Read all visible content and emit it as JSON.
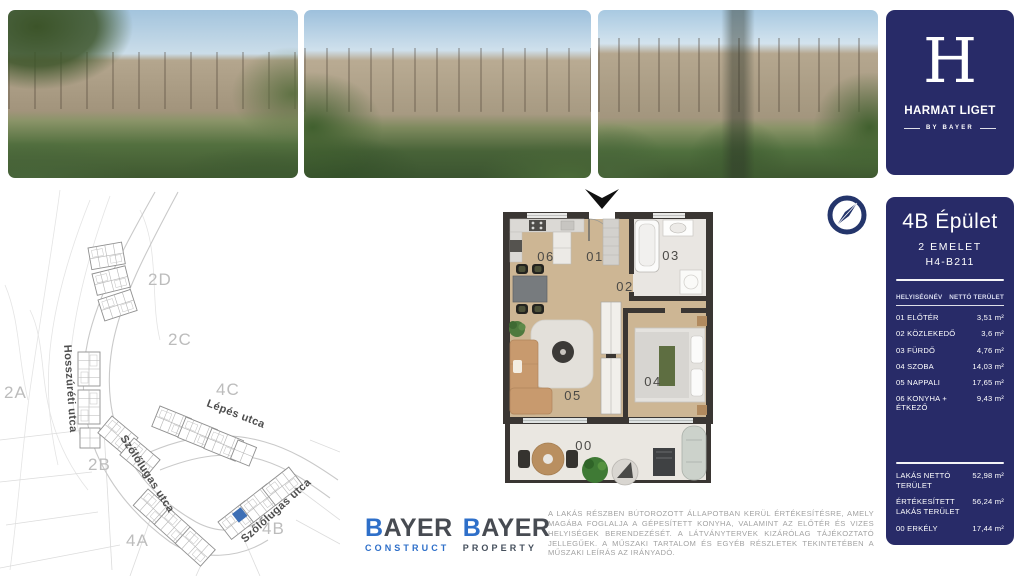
{
  "brand": {
    "letter": "H",
    "name": "HARMAT LIGET",
    "tagline": "BY BAYER"
  },
  "unit": {
    "title": "4B Épület",
    "floor": "2 EMELET",
    "code": "H4-B211"
  },
  "room_table": {
    "header_name": "HELYISÉGNÉV",
    "header_area": "NETTÓ TERÜLET",
    "rows": [
      {
        "label": "01 ELŐTÉR",
        "value": "3,51 m²"
      },
      {
        "label": "02 KÖZLEKEDŐ",
        "value": "3,6 m²"
      },
      {
        "label": "03 FÜRDŐ",
        "value": "4,76 m²"
      },
      {
        "label": "04 SZOBA",
        "value": "14,03 m²"
      },
      {
        "label": "05 NAPPALI",
        "value": "17,65 m²"
      },
      {
        "label": "06 KONYHA + ÉTKEZŐ",
        "value": "9,43 m²"
      }
    ],
    "totals": [
      {
        "label": "LAKÁS NETTÓ TERÜLET",
        "value": "52,98 m²"
      },
      {
        "label": "ÉRTÉKESÍTETT LAKÁS TERÜLET",
        "value": "56,24 m²"
      },
      {
        "label": "00 ERKÉLY",
        "value": "17,44 m²"
      }
    ]
  },
  "floor_plan": {
    "rooms": [
      "06",
      "01",
      "03",
      "02",
      "05",
      "04",
      "00"
    ]
  },
  "site_map": {
    "areas": [
      "2D",
      "2C",
      "2A",
      "4C",
      "2B",
      "4A",
      "4B"
    ],
    "streets": [
      "Hosszúréti utca",
      "Lépés utca",
      "Szőlőlugas utca",
      "Szőlőlugas utca"
    ],
    "highlight_color": "#3d6fb5"
  },
  "logos": [
    {
      "initial": "B",
      "rest": "AYER",
      "division": "CONSTRUCT"
    },
    {
      "initial": "B",
      "rest": "AYER",
      "division": "PROPERTY"
    }
  ],
  "disclaimer": "A LAKÁS RÉSZBEN BÚTOROZOTT ÁLLAPOTBAN KERÜL ÉRTÉKESÍTÉSRE, AMELY MAGÁBA FOGLALJA A GÉPESÍTETT KONYHA, VALAMINT AZ ELŐTÉR ÉS VIZES HELYISÉGEK BERENDEZÉSÉT. A LÁTVÁNYTERVEK KIZÁRÓLAG TÁJÉKOZTATÓ JELLEGŰEK. A MŰSZAKI TARTALOM ÉS EGYÉB RÉSZLETEK TEKINTETÉBEN A MŰSZAKI LEÍRÁS AZ IRÁNYADÓ.",
  "colors": {
    "navy": "#282b68",
    "accent_blue": "#2e6fc9",
    "wall": "#3a3633",
    "wood": "#cdb694"
  }
}
